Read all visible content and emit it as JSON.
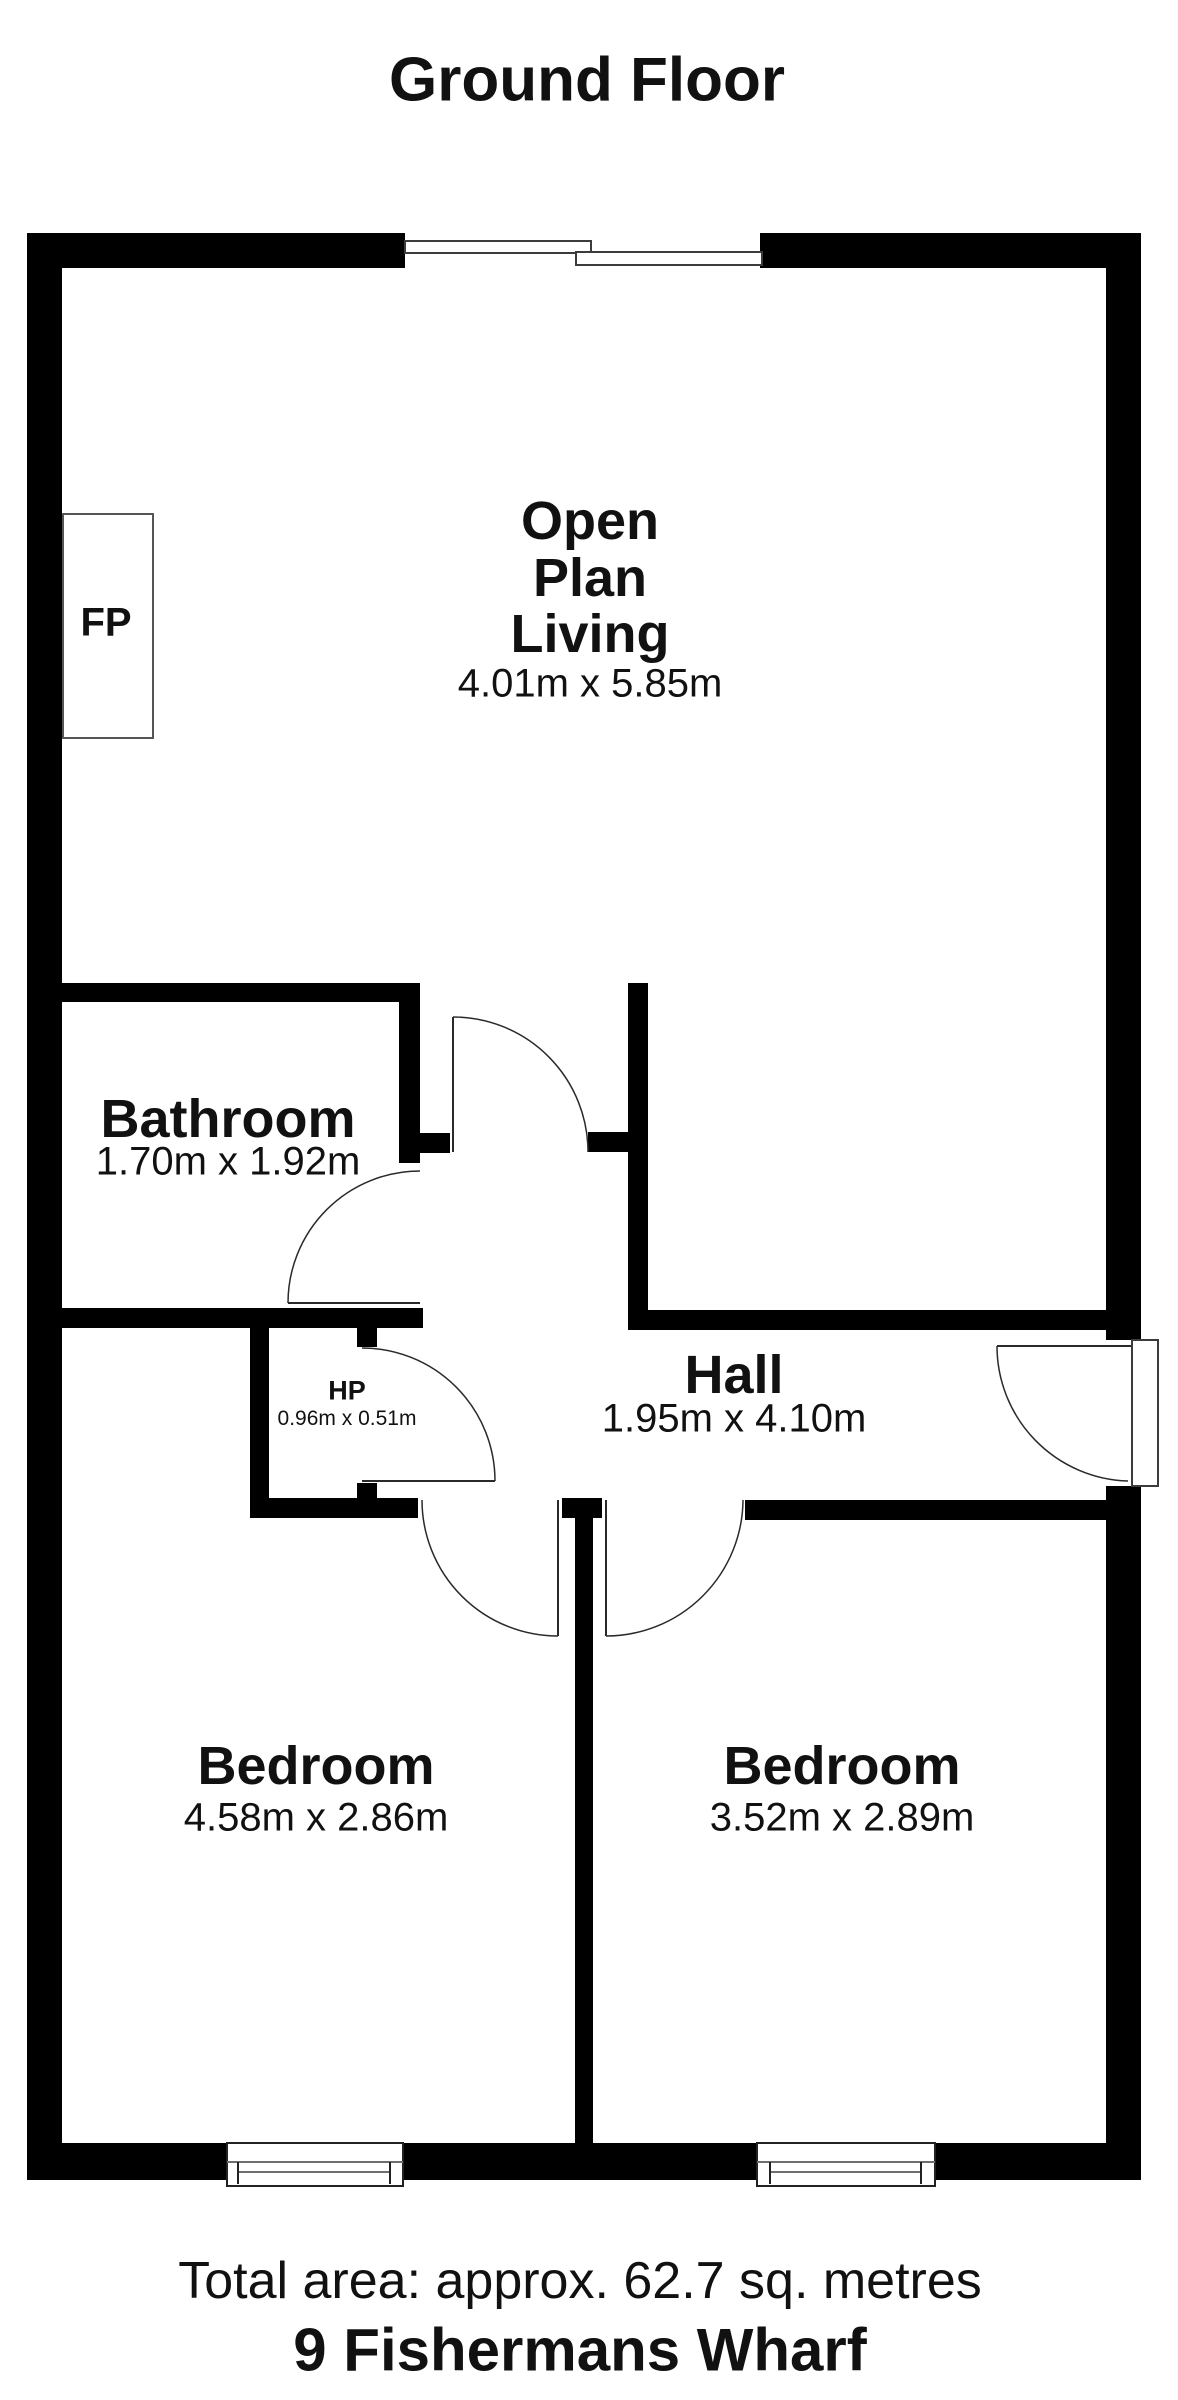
{
  "title": "Ground Floor",
  "rooms": {
    "open_plan": {
      "line1": "Open",
      "line2": "Plan",
      "line3": "Living",
      "dims": "4.01m x 5.85m"
    },
    "bathroom": {
      "name": "Bathroom",
      "dims": "1.70m x 1.92m"
    },
    "hp": {
      "name": "HP",
      "dims": "0.96m x 0.51m"
    },
    "hall": {
      "name": "Hall",
      "dims": "1.95m x 4.10m"
    },
    "bedroom_left": {
      "name": "Bedroom",
      "dims": "4.58m x 2.86m"
    },
    "bedroom_right": {
      "name": "Bedroom",
      "dims": "3.52m x 2.89m"
    },
    "fireplace": {
      "label": "FP"
    }
  },
  "footer": {
    "total_area": "Total area: approx. 62.7 sq. metres",
    "address": "9 Fishermans Wharf"
  },
  "colors": {
    "wall": "#000000",
    "background": "#ffffff",
    "door_line": "#2a2a2a",
    "window_border": "#3c3c3c",
    "window_inner_line": "#6e6e6e"
  }
}
